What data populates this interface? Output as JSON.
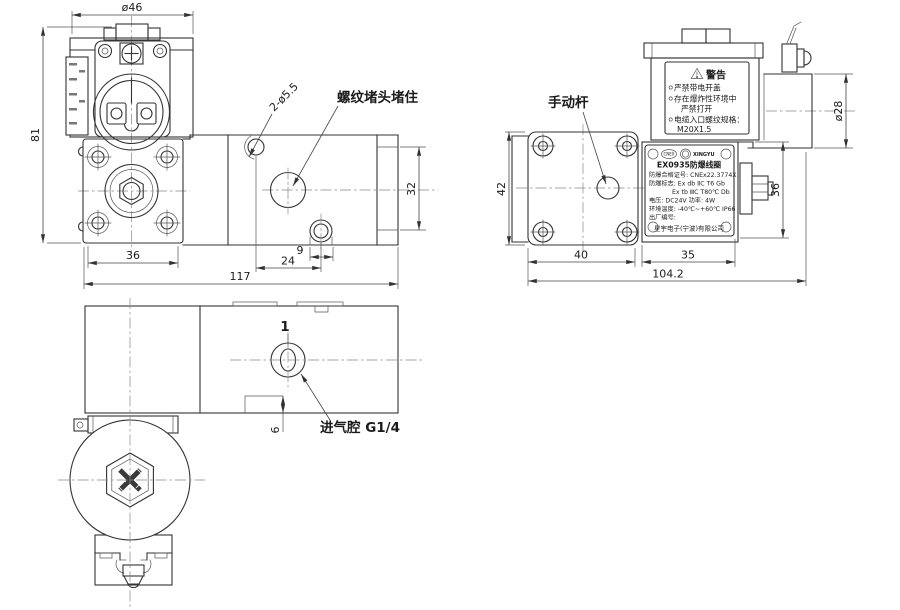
{
  "views": {
    "front": {
      "dims": {
        "coil_dia": "ø46",
        "total_h": "81",
        "flange_w": "36",
        "total_w": "117",
        "body_h": "32",
        "notch_w": "9",
        "hole_span": "24",
        "mount_holes": "2-ø5.5"
      },
      "labels": {
        "plug": "螺纹堵头堵住"
      }
    },
    "side": {
      "dims": {
        "flange_h": "42",
        "flange_w": "40",
        "body_w": "35",
        "total_w": "104.2",
        "coil_dia": "ø28",
        "body_h": "36"
      },
      "labels": {
        "lever": "手动杆"
      },
      "warning": {
        "title": "警告",
        "items": [
          "严禁带电开盖",
          "存在爆炸性环境中",
          "严禁打开",
          "电缆入口螺纹规格：",
          "M20X1.5"
        ]
      },
      "nameplate": {
        "cert_logo": "CNEX",
        "brand": "XINGYU",
        "title": "EX0935防爆线圈",
        "line1": "防爆合格证号: CNEx22.3774X",
        "line2": "防爆标志: Ex db ⅡC T6 Gb",
        "line3": "Ex tb ⅢC T80℃ Db",
        "line4": "电压: DC24V   功率: 4W",
        "line5": "环境温度: -40℃~+60℃   IP66",
        "line6": "出厂编号:",
        "company": "星宇电子(宁波)有限公司"
      }
    },
    "bottom": {
      "dims": {
        "step_h": "6"
      },
      "labels": {
        "port_no": "1",
        "inlet": "进气腔 G1/4"
      }
    }
  }
}
